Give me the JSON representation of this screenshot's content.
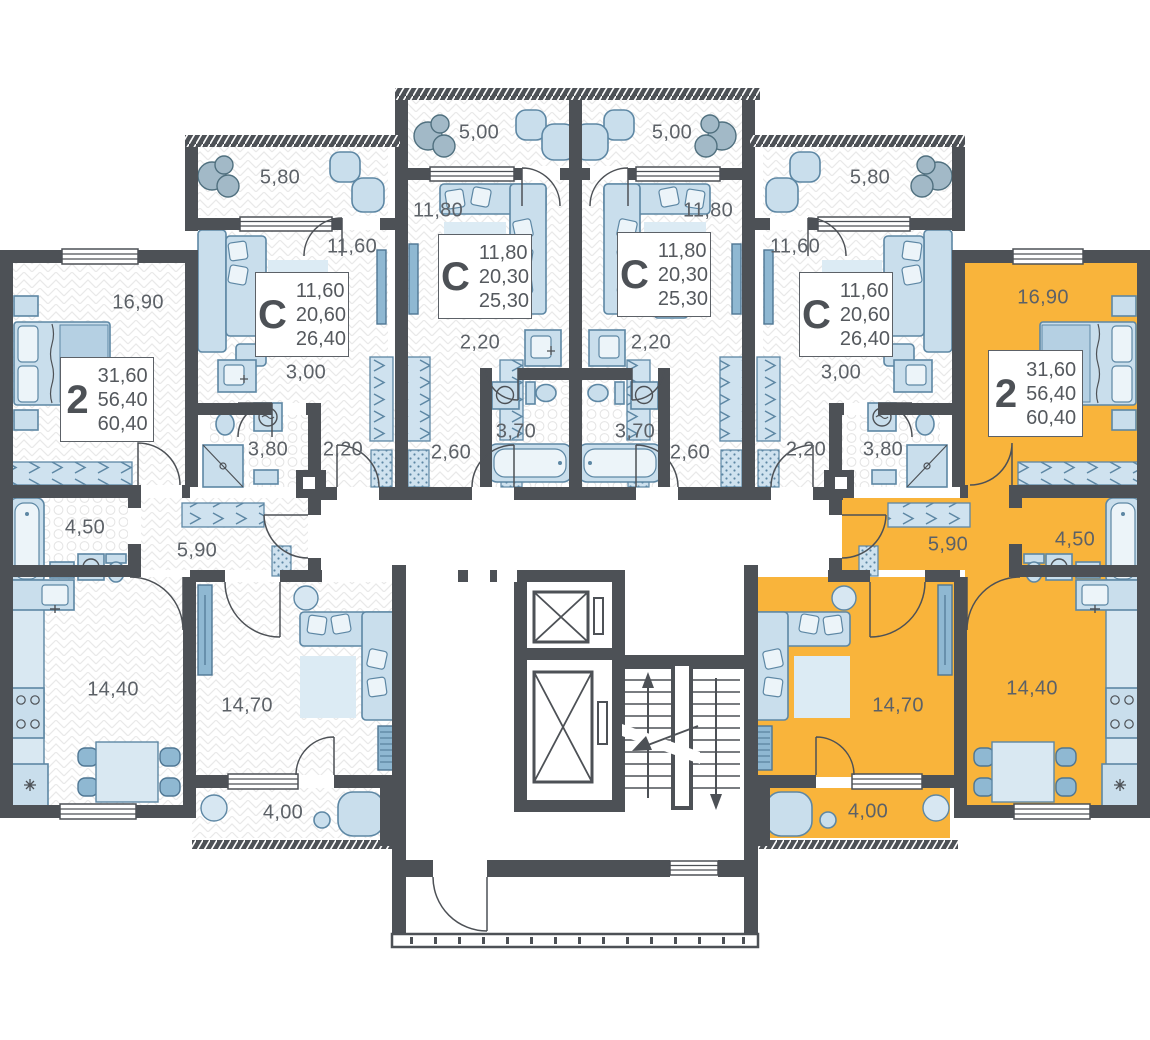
{
  "floorplan": {
    "selected_apartment": "right-2room",
    "colors": {
      "highlight": "#F9B43B",
      "walls": "#4D5156",
      "furniture": "#C9DEEC"
    },
    "core": {
      "elevator_count": 2,
      "stairs": "stairwell"
    },
    "apartments": [
      {
        "id": "left-2room",
        "type": "2",
        "highlighted": false,
        "area_living": "31,60",
        "area_main": "56,40",
        "area_total": "60,40",
        "rooms": [
          {
            "name": "bedroom",
            "area": "16,90"
          },
          {
            "name": "bathroom",
            "area": "4,50"
          },
          {
            "name": "hallway",
            "area": "5,90"
          },
          {
            "name": "kitchen",
            "area": "14,40"
          },
          {
            "name": "living-room",
            "area": "14,70"
          },
          {
            "name": "balcony",
            "area": "4,00"
          }
        ]
      },
      {
        "id": "left-studio",
        "type": "С",
        "highlighted": false,
        "area_living": "11,60",
        "area_main": "20,60",
        "area_total": "26,40",
        "rooms": [
          {
            "name": "balcony",
            "area": "5,80"
          },
          {
            "name": "room",
            "area": "11,60"
          },
          {
            "name": "hallway",
            "area": "3,00"
          },
          {
            "name": "bathroom",
            "area": "3,80"
          },
          {
            "name": "wardrobe",
            "area": "2,20"
          }
        ]
      },
      {
        "id": "center-left-studio",
        "type": "С",
        "highlighted": false,
        "area_living": "11,80",
        "area_main": "20,30",
        "area_total": "25,30",
        "rooms": [
          {
            "name": "balcony",
            "area": "5,00"
          },
          {
            "name": "room",
            "area": "11,80"
          },
          {
            "name": "wardrobe",
            "area": "2,20"
          },
          {
            "name": "bathroom",
            "area": "3,70"
          },
          {
            "name": "hallway",
            "area": "2,60"
          }
        ]
      },
      {
        "id": "center-right-studio",
        "type": "С",
        "highlighted": false,
        "area_living": "11,80",
        "area_main": "20,30",
        "area_total": "25,30",
        "rooms": [
          {
            "name": "balcony",
            "area": "5,00"
          },
          {
            "name": "room",
            "area": "11,80"
          },
          {
            "name": "wardrobe",
            "area": "2,20"
          },
          {
            "name": "bathroom",
            "area": "3,70"
          },
          {
            "name": "hallway",
            "area": "2,60"
          }
        ]
      },
      {
        "id": "right-studio",
        "type": "С",
        "highlighted": false,
        "area_living": "11,60",
        "area_main": "20,60",
        "area_total": "26,40",
        "rooms": [
          {
            "name": "balcony",
            "area": "5,80"
          },
          {
            "name": "room",
            "area": "11,60"
          },
          {
            "name": "hallway",
            "area": "3,00"
          },
          {
            "name": "bathroom",
            "area": "3,80"
          },
          {
            "name": "wardrobe",
            "area": "2,20"
          }
        ]
      },
      {
        "id": "right-2room",
        "type": "2",
        "highlighted": true,
        "area_living": "31,60",
        "area_main": "56,40",
        "area_total": "60,40",
        "rooms": [
          {
            "name": "bedroom",
            "area": "16,90"
          },
          {
            "name": "bathroom",
            "area": "4,50"
          },
          {
            "name": "hallway",
            "area": "5,90"
          },
          {
            "name": "kitchen",
            "area": "14,40"
          },
          {
            "name": "living-room",
            "area": "14,70"
          },
          {
            "name": "balcony",
            "area": "4,00"
          }
        ]
      }
    ]
  }
}
